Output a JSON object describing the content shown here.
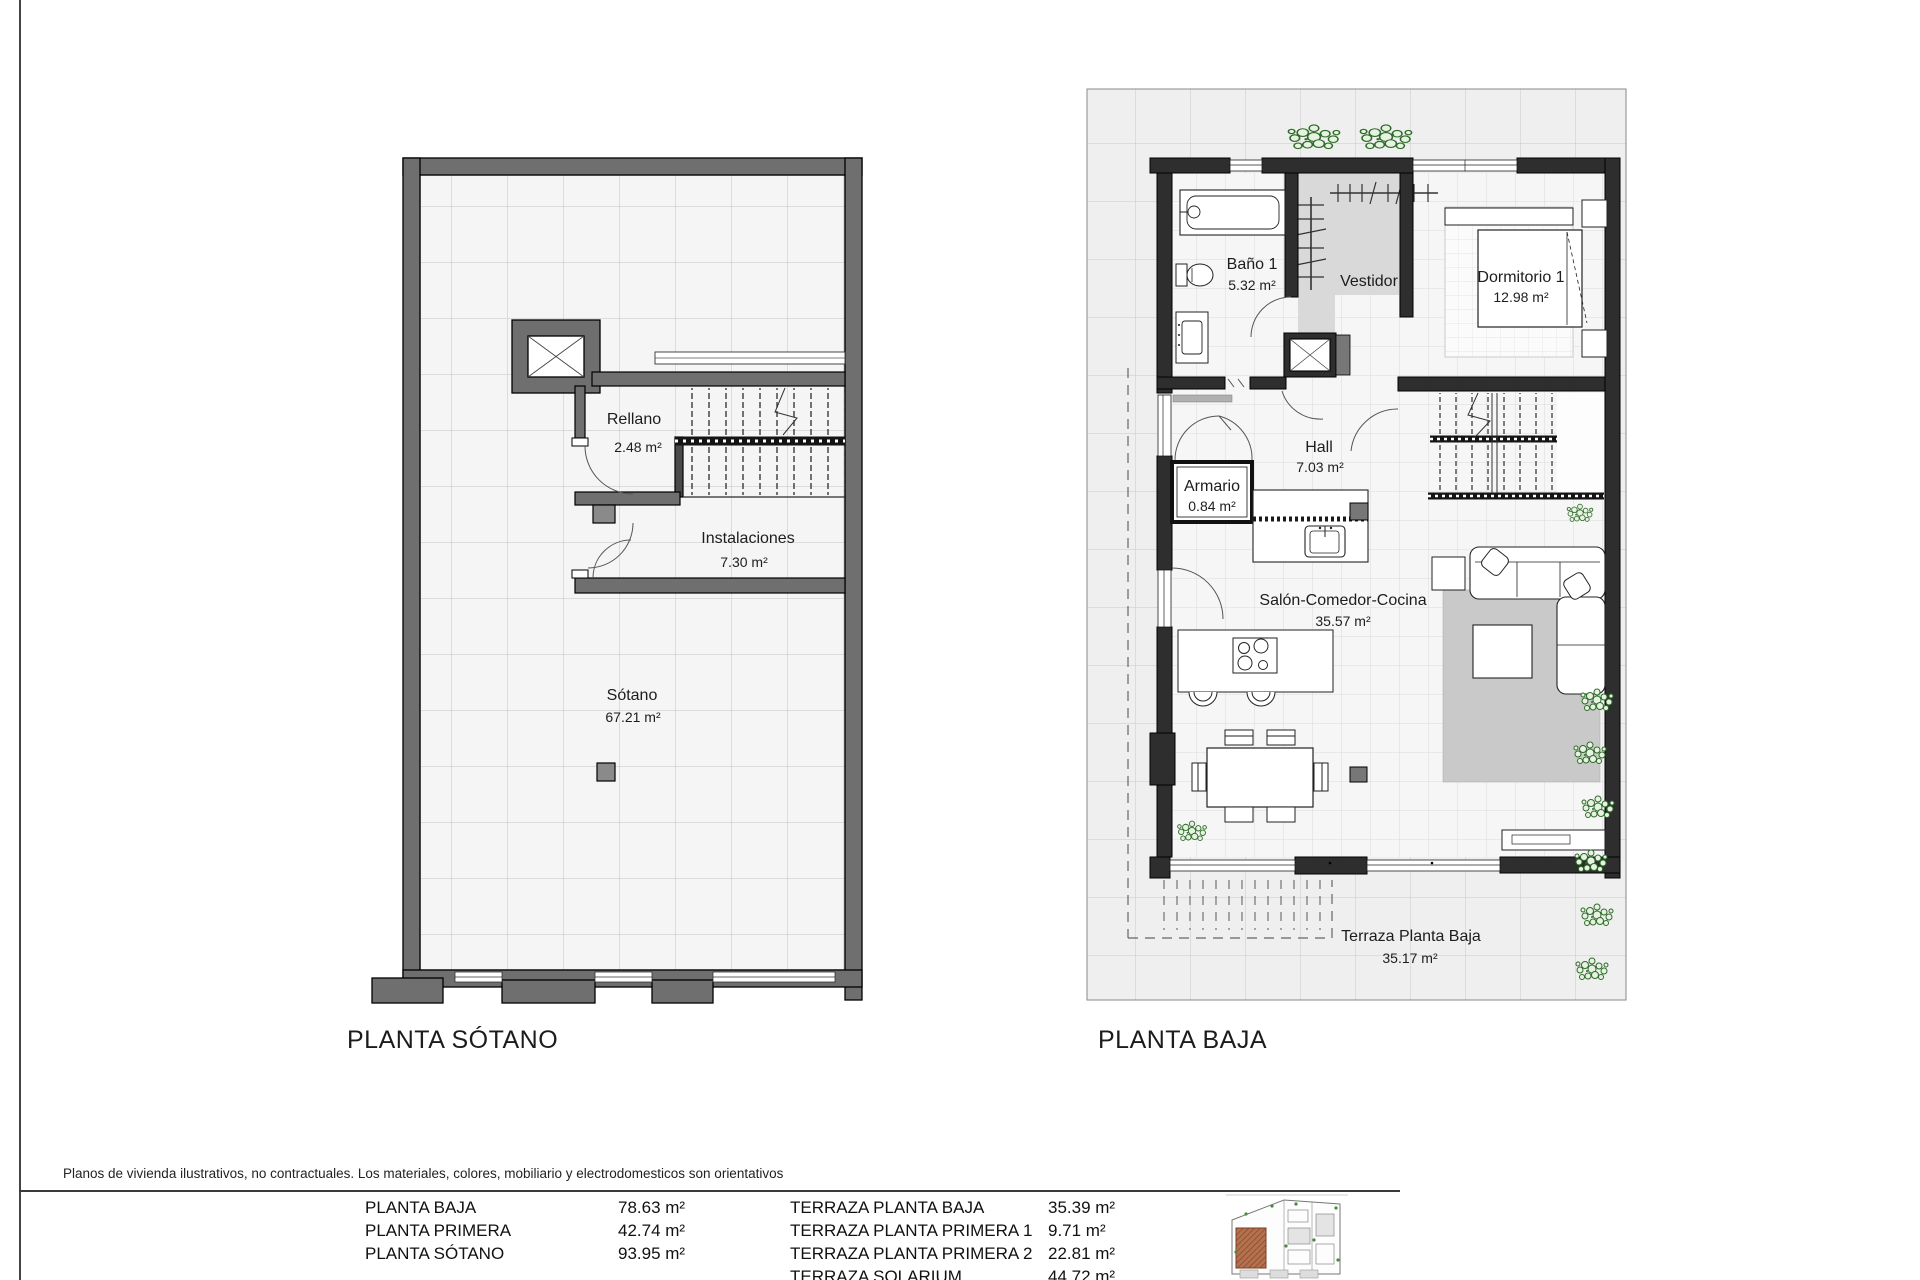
{
  "colors": {
    "wall_gray": "#6f6f6f",
    "wall_dark": "#2e2e2e",
    "column_gray": "#8a8a8a",
    "rug_gray": "#c9c9c9",
    "vestidor_gray": "#d9d9d9",
    "plant_green": "#2e6b28",
    "plot_highlight": "#b4714e"
  },
  "plans": {
    "sotano": {
      "title": "PLANTA SÓTANO",
      "rooms": [
        {
          "name": "Rellano",
          "area": "2.48 m²"
        },
        {
          "name": "Instalaciones",
          "area": "7.30 m²"
        },
        {
          "name": "Sótano",
          "area": "67.21 m²"
        }
      ]
    },
    "baja": {
      "title": "PLANTA BAJA",
      "rooms": [
        {
          "name": "Baño 1",
          "area": "5.32 m²"
        },
        {
          "name": "Vestidor",
          "area": ""
        },
        {
          "name": "Dormitorio 1",
          "area": "12.98 m²"
        },
        {
          "name": "Hall",
          "area": "7.03 m²"
        },
        {
          "name": "Armario",
          "area": "0.84 m²"
        },
        {
          "name": "Salón-Comedor-Cocina",
          "area": "35.57 m²"
        },
        {
          "name": "Terraza Planta Baja",
          "area": "35.17 m²"
        }
      ]
    }
  },
  "footer": {
    "disclaimer": "Planos de vivienda ilustrativos, no contractuales. Los materiales, colores, mobiliario y electrodomesticos son orientativos",
    "areas_table": {
      "left": [
        {
          "label": "PLANTA BAJA",
          "value": "78.63 m²"
        },
        {
          "label": "PLANTA PRIMERA",
          "value": "42.74 m²"
        },
        {
          "label": "PLANTA SÓTANO",
          "value": "93.95 m²"
        }
      ],
      "right": [
        {
          "label": "TERRAZA PLANTA BAJA",
          "value": "35.39 m²"
        },
        {
          "label": "TERRAZA PLANTA PRIMERA 1",
          "value": "9.71 m²"
        },
        {
          "label": "TERRAZA PLANTA PRIMERA 2",
          "value": "22.81 m²"
        },
        {
          "label": "TERRAZA SOLARIUM",
          "value": "44.72 m²"
        }
      ]
    }
  }
}
